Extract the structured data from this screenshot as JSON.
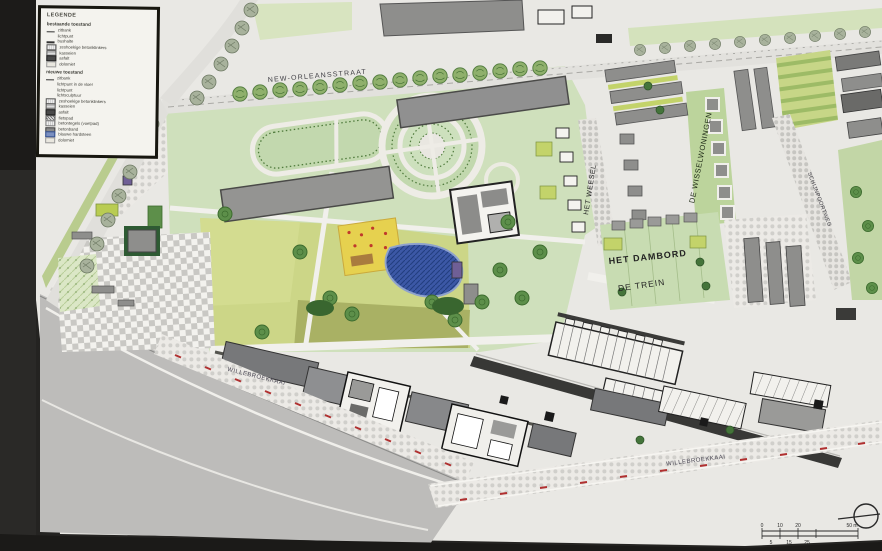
{
  "legend": {
    "title": "LEGENDE",
    "existing": {
      "header": "bestaande toestand",
      "items": [
        {
          "symbol": "bench",
          "label": "zitbank"
        },
        {
          "symbol": "light-point",
          "label": "lichtpunt"
        },
        {
          "symbol": "bus-stop",
          "label": "bushalte"
        },
        {
          "symbol": "hex-pavers",
          "label": "zeshoekige betonklinkers"
        },
        {
          "symbol": "cobbles",
          "label": "kasseien"
        },
        {
          "symbol": "asphalt",
          "label": "asfalt"
        },
        {
          "symbol": "dolomite",
          "label": "dolomiet"
        }
      ]
    },
    "new": {
      "header": "nieuwe toestand",
      "items": [
        {
          "symbol": "bench",
          "label": "zitbank"
        },
        {
          "symbol": "floor-light",
          "label": "lichtpunt in de vloer"
        },
        {
          "symbol": "light-point",
          "label": "lichtpunt"
        },
        {
          "symbol": "light-sculpture",
          "label": "lichtsculptuur"
        },
        {
          "symbol": "hex-pavers",
          "label": "zeshoekige betonklinkers"
        },
        {
          "symbol": "cobbles",
          "label": "kasseien"
        },
        {
          "symbol": "asphalt",
          "label": "asfalt"
        },
        {
          "symbol": "cycle-path",
          "label": "fietspad"
        },
        {
          "symbol": "concrete-tiles",
          "label": "betontegels (voetpad)"
        },
        {
          "symbol": "concrete-edge",
          "label": "betonband"
        },
        {
          "symbol": "bluestone",
          "label": "blauwe hardsteen"
        },
        {
          "symbol": "dolomite",
          "label": "dolomiet"
        }
      ]
    }
  },
  "streets": {
    "new_orleansstraat": "NEW-ORLEANSSTRAAT",
    "quay_left": "WILLEBROEKKAAI",
    "quay_right": "WILLEBROEKKAAI",
    "right_street": "SCHIJNPOORTWEG"
  },
  "districts": {
    "het_weesel": "HET WEESEL",
    "de_wisselwoningen": "DE WISSELWONINGEN",
    "het_dambord": "HET DAMBORD",
    "de_trein": "DE TREIN"
  },
  "scalebar": {
    "top": [
      "0",
      "10",
      "20",
      "50 m"
    ],
    "bottom": [
      "5",
      "15",
      "25"
    ]
  },
  "colors": {
    "paper": "#e9e8e4",
    "park_green": "#cfe0bc",
    "lawn_yellow": "#ccd687",
    "lawn_olive": "#a9b164",
    "water_gray": "#bdbcba",
    "building_gray": "#8e8e8c",
    "building_dark": "#5a5a58",
    "pond_blue": "#3c58a6",
    "playground_yellow": "#e6d14f",
    "tree_green": "#5d8f4a",
    "accent_purple": "#6f5f96"
  }
}
